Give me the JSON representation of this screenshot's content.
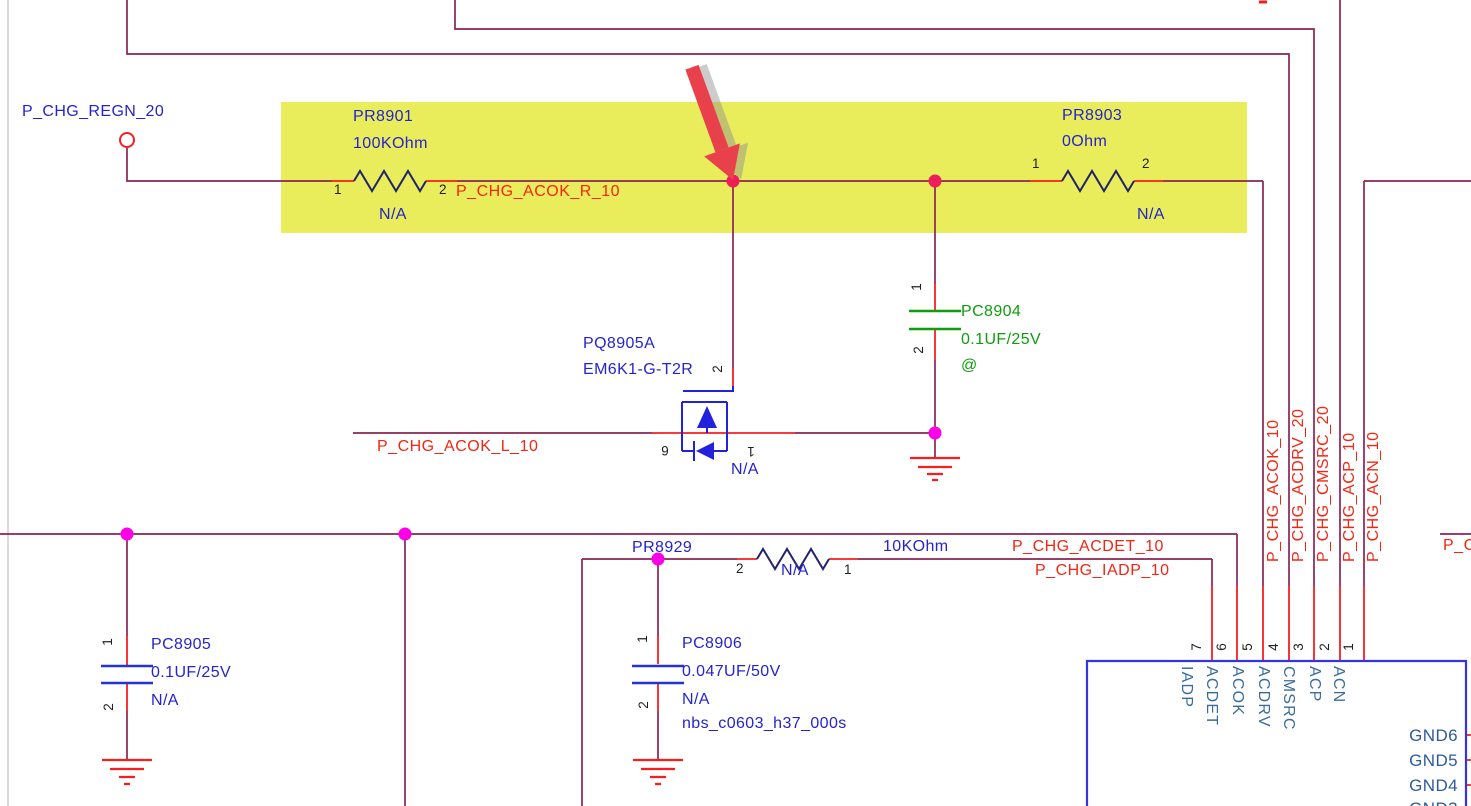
{
  "ports": {
    "regn": "P_CHG_REGN_20"
  },
  "components": {
    "pr8901": {
      "ref": "PR8901",
      "value": "100KOhm",
      "fit": "N/A",
      "pin1": "1",
      "pin2": "2"
    },
    "pr8903": {
      "ref": "PR8903",
      "value": "0Ohm",
      "fit": "N/A",
      "pin1": "1",
      "pin2": "2"
    },
    "pr8929": {
      "ref": "PR8929",
      "value": "10KOhm",
      "fit": "N/A",
      "pin1": "1",
      "pin2": "2"
    },
    "pc8904": {
      "ref": "PC8904",
      "value": "0.1UF/25V",
      "fit": "@",
      "pin1": "1",
      "pin2": "2"
    },
    "pc8905": {
      "ref": "PC8905",
      "value": "0.1UF/25V",
      "fit": "N/A",
      "pin1": "1",
      "pin2": "2"
    },
    "pc8906": {
      "ref": "PC8906",
      "value": "0.047UF/50V",
      "fit": "N/A",
      "footprint": "nbs_c0603_h37_000s",
      "pin1": "1",
      "pin2": "2"
    },
    "pq8905a": {
      "ref": "PQ8905A",
      "part": "EM6K1-G-T2R",
      "fit": "N/A",
      "pin_gate": "2",
      "pin_source": "6",
      "pin_drain": "1"
    }
  },
  "nets": {
    "acok_r": "P_CHG_ACOK_R_10",
    "acok_l": "P_CHG_ACOK_L_10",
    "acdet": "P_CHG_ACDET_10",
    "iadp": "P_CHG_IADP_10",
    "right_edge_truncated": "P_C",
    "vertical": [
      "P_CHG_ACOK_10",
      "P_CHG_ACDRV_20",
      "P_CHG_CMSRC_20",
      "P_CHG_ACP_10",
      "P_CHG_ACN_10"
    ]
  },
  "ic": {
    "top_pins": [
      {
        "number": "7",
        "name": "IADP"
      },
      {
        "number": "6",
        "name": "ACDET"
      },
      {
        "number": "5",
        "name": "ACOK"
      },
      {
        "number": "4",
        "name": "ACDRV"
      },
      {
        "number": "3",
        "name": "CMSRC"
      },
      {
        "number": "2",
        "name": "ACP"
      },
      {
        "number": "1",
        "name": "ACN"
      }
    ],
    "right_pins": [
      "GND6",
      "GND5",
      "GND4",
      "GND3"
    ]
  },
  "colors": {
    "wire": "#8A2454",
    "pin_stub": "#F81E1E",
    "net_label": "#F42613",
    "highlight": "#E9ED5B",
    "junction_upper": "#ED1E5A",
    "junction_lower": "#FC00E8",
    "component_text": "#2424CE",
    "capacitor_green": "#0D9E0D",
    "ic_outline": "#3434E0",
    "pin_name_text": "#3A6B9E",
    "arrow": "#E8414B"
  }
}
